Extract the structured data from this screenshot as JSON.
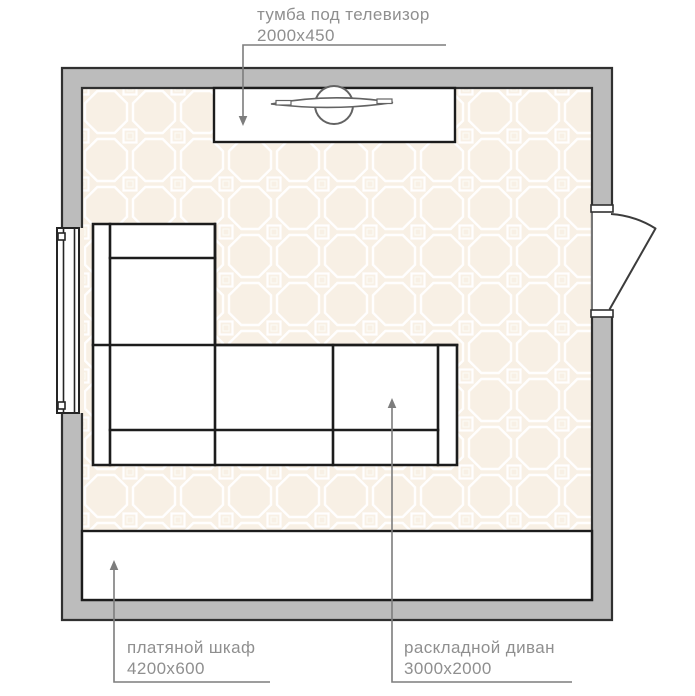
{
  "labels": {
    "tv_stand": {
      "name": "тумба под телевизор",
      "size": "2000x450"
    },
    "wardrobe": {
      "name": "платяной шкаф",
      "size": "4200x600"
    },
    "sofa": {
      "name": "раскладной диван",
      "size": "3000x2000"
    }
  },
  "colors": {
    "background": "#ffffff",
    "wall_fill": "#bcbcbc",
    "wall_outline": "#303030",
    "floor": "#f8f0e5",
    "tile_line": "#ffffff",
    "furniture_fill": "#ffffff",
    "furniture_outline": "#1c1c1c",
    "tv_outline": "#636363",
    "leader_line": "#7d7d7d",
    "label_text": "#8f8f8f"
  }
}
